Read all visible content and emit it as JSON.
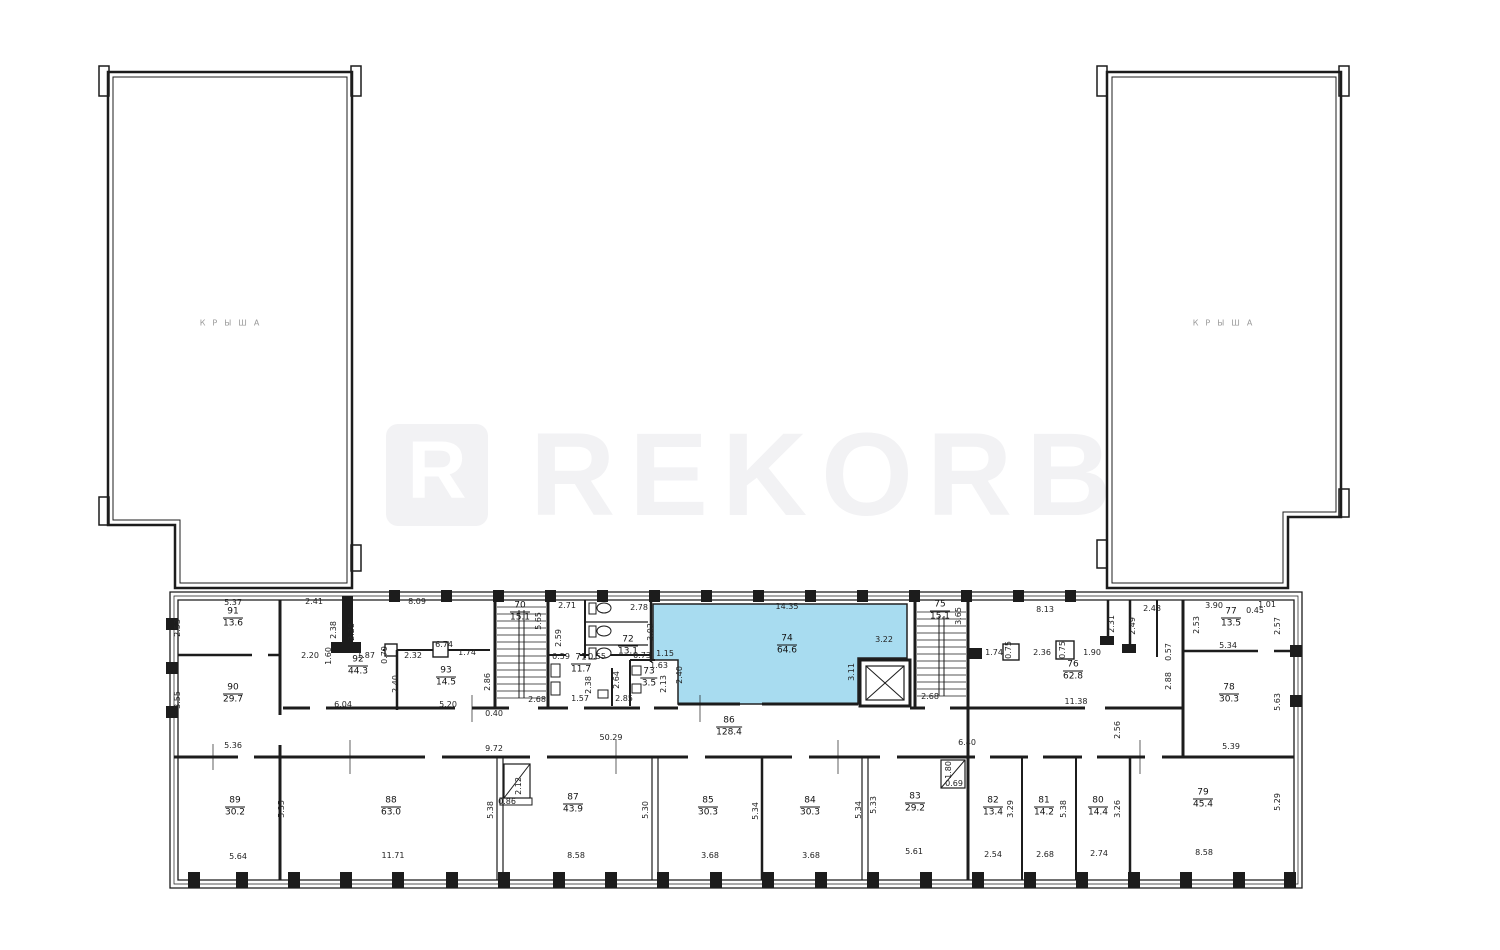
{
  "plan": {
    "towers": {
      "left_label": "КРЫША",
      "right_label": "КРЫША"
    },
    "watermark": {
      "logo_letter": "R",
      "text": "REKORB"
    },
    "highlight": {
      "number": "74",
      "area": "64.6",
      "fill": "#a8dcf0"
    },
    "rooms": [
      {
        "number": "91",
        "area": "13.6",
        "x": 233,
        "y": 618
      },
      {
        "number": "90",
        "area": "29.7",
        "x": 233,
        "y": 694
      },
      {
        "number": "92",
        "area": "44.3",
        "x": 358,
        "y": 666
      },
      {
        "number": "93",
        "area": "14.5",
        "x": 446,
        "y": 677
      },
      {
        "number": "70",
        "area": "15.1",
        "x": 520,
        "y": 612
      },
      {
        "number": "71",
        "area": "11.7",
        "x": 581,
        "y": 664
      },
      {
        "number": "72",
        "area": "13.1",
        "x": 628,
        "y": 646
      },
      {
        "number": "73",
        "area": "3.5",
        "x": 649,
        "y": 678
      },
      {
        "number": "74",
        "area": "64.6",
        "x": 787,
        "y": 645,
        "highlight": true
      },
      {
        "number": "75",
        "area": "15.1",
        "x": 940,
        "y": 611
      },
      {
        "number": "76",
        "area": "62.8",
        "x": 1073,
        "y": 671
      },
      {
        "number": "77",
        "area": "13.5",
        "x": 1231,
        "y": 618
      },
      {
        "number": "78",
        "area": "30.3",
        "x": 1229,
        "y": 694
      },
      {
        "number": "86",
        "area": "128.4",
        "x": 729,
        "y": 727
      },
      {
        "number": "89",
        "area": "30.2",
        "x": 235,
        "y": 807
      },
      {
        "number": "88",
        "area": "63.0",
        "x": 391,
        "y": 807
      },
      {
        "number": "87",
        "area": "43.9",
        "x": 573,
        "y": 804
      },
      {
        "number": "85",
        "area": "30.3",
        "x": 708,
        "y": 807
      },
      {
        "number": "84",
        "area": "30.3",
        "x": 810,
        "y": 807
      },
      {
        "number": "83",
        "area": "29.2",
        "x": 915,
        "y": 803
      },
      {
        "number": "82",
        "area": "13.4",
        "x": 993,
        "y": 807
      },
      {
        "number": "81",
        "area": "14.2",
        "x": 1044,
        "y": 807
      },
      {
        "number": "80",
        "area": "14.4",
        "x": 1098,
        "y": 807
      },
      {
        "number": "79",
        "area": "45.4",
        "x": 1203,
        "y": 799
      }
    ],
    "dimensions": [
      {
        "t": "5.37",
        "x": 233,
        "y": 603
      },
      {
        "t": "2.53",
        "x": 178,
        "y": 628,
        "r": 1
      },
      {
        "t": "3.55",
        "x": 178,
        "y": 700,
        "r": 1
      },
      {
        "t": "5.36",
        "x": 233,
        "y": 746
      },
      {
        "t": "2.41",
        "x": 314,
        "y": 602
      },
      {
        "t": "2.38",
        "x": 334,
        "y": 630,
        "r": 1
      },
      {
        "t": "2.28",
        "x": 352,
        "y": 632,
        "r": 1
      },
      {
        "t": "8.09",
        "x": 417,
        "y": 602
      },
      {
        "t": "2.20",
        "x": 310,
        "y": 656
      },
      {
        "t": "1.60",
        "x": 329,
        "y": 656,
        "r": 1
      },
      {
        "t": "1.87",
        "x": 366,
        "y": 656
      },
      {
        "t": "0.79",
        "x": 385,
        "y": 655,
        "r": 1
      },
      {
        "t": "2.32",
        "x": 413,
        "y": 656
      },
      {
        "t": "6.74",
        "x": 444,
        "y": 645
      },
      {
        "t": "1.74",
        "x": 467,
        "y": 653
      },
      {
        "t": "2.40",
        "x": 396,
        "y": 684,
        "r": 1
      },
      {
        "t": "2.86",
        "x": 488,
        "y": 682,
        "r": 1
      },
      {
        "t": "6.04",
        "x": 343,
        "y": 705
      },
      {
        "t": "5.20",
        "x": 448,
        "y": 705
      },
      {
        "t": "0.40",
        "x": 494,
        "y": 714
      },
      {
        "t": "2.68",
        "x": 537,
        "y": 700
      },
      {
        "t": "5.65",
        "x": 539,
        "y": 621,
        "r": 1
      },
      {
        "t": "2.71",
        "x": 567,
        "y": 606
      },
      {
        "t": "2.59",
        "x": 559,
        "y": 638,
        "r": 1
      },
      {
        "t": "2.78",
        "x": 639,
        "y": 608
      },
      {
        "t": "3.02",
        "x": 651,
        "y": 632,
        "r": 1
      },
      {
        "t": "0.59",
        "x": 561,
        "y": 657
      },
      {
        "t": "0.55",
        "x": 597,
        "y": 657
      },
      {
        "t": "0.73",
        "x": 642,
        "y": 656
      },
      {
        "t": "1.15",
        "x": 665,
        "y": 654
      },
      {
        "t": "1.63",
        "x": 659,
        "y": 666
      },
      {
        "t": "2.13",
        "x": 664,
        "y": 684,
        "r": 1
      },
      {
        "t": "2.38",
        "x": 589,
        "y": 685,
        "r": 1
      },
      {
        "t": "2.64",
        "x": 617,
        "y": 680,
        "r": 1
      },
      {
        "t": "1.57",
        "x": 580,
        "y": 699
      },
      {
        "t": "2.85",
        "x": 624,
        "y": 699
      },
      {
        "t": "2.40",
        "x": 680,
        "y": 675,
        "r": 1
      },
      {
        "t": "14.35",
        "x": 787,
        "y": 607
      },
      {
        "t": "3.22",
        "x": 884,
        "y": 640
      },
      {
        "t": "3.11",
        "x": 852,
        "y": 672,
        "r": 1
      },
      {
        "t": "3.65",
        "x": 959,
        "y": 616,
        "r": 1
      },
      {
        "t": "2.68",
        "x": 930,
        "y": 697
      },
      {
        "t": "8.13",
        "x": 1045,
        "y": 610
      },
      {
        "t": "1.74",
        "x": 994,
        "y": 653
      },
      {
        "t": "0.75",
        "x": 1009,
        "y": 650,
        "r": 1
      },
      {
        "t": "2.36",
        "x": 1042,
        "y": 653
      },
      {
        "t": "0.75",
        "x": 1063,
        "y": 650,
        "r": 1
      },
      {
        "t": "1.90",
        "x": 1092,
        "y": 653
      },
      {
        "t": "2.31",
        "x": 1112,
        "y": 624,
        "r": 1
      },
      {
        "t": "2.49",
        "x": 1133,
        "y": 626,
        "r": 1
      },
      {
        "t": "2.48",
        "x": 1152,
        "y": 609
      },
      {
        "t": "11.38",
        "x": 1076,
        "y": 702
      },
      {
        "t": "2.56",
        "x": 1118,
        "y": 730,
        "r": 1
      },
      {
        "t": "6.40",
        "x": 967,
        "y": 743
      },
      {
        "t": "1.80",
        "x": 949,
        "y": 770,
        "r": 1
      },
      {
        "t": "0.69",
        "x": 954,
        "y": 784
      },
      {
        "t": "3.90",
        "x": 1214,
        "y": 606
      },
      {
        "t": "0.45",
        "x": 1255,
        "y": 611
      },
      {
        "t": "1.01",
        "x": 1267,
        "y": 605
      },
      {
        "t": "2.53",
        "x": 1197,
        "y": 625,
        "r": 1
      },
      {
        "t": "2.57",
        "x": 1278,
        "y": 626,
        "r": 1
      },
      {
        "t": "5.34",
        "x": 1228,
        "y": 646
      },
      {
        "t": "0.57",
        "x": 1169,
        "y": 652,
        "r": 1
      },
      {
        "t": "2.88",
        "x": 1169,
        "y": 681,
        "r": 1
      },
      {
        "t": "5.63",
        "x": 1278,
        "y": 702,
        "r": 1
      },
      {
        "t": "5.39",
        "x": 1231,
        "y": 747
      },
      {
        "t": "5.29",
        "x": 1278,
        "y": 802,
        "r": 1
      },
      {
        "t": "50.29",
        "x": 611,
        "y": 738
      },
      {
        "t": "9.72",
        "x": 494,
        "y": 749
      },
      {
        "t": "2.12",
        "x": 519,
        "y": 786,
        "r": 1
      },
      {
        "t": "0.86",
        "x": 507,
        "y": 802
      },
      {
        "t": "5.64",
        "x": 238,
        "y": 857
      },
      {
        "t": "5.35",
        "x": 282,
        "y": 809,
        "r": 1
      },
      {
        "t": "11.71",
        "x": 393,
        "y": 856
      },
      {
        "t": "5.38",
        "x": 491,
        "y": 810,
        "r": 1
      },
      {
        "t": "8.58",
        "x": 576,
        "y": 856
      },
      {
        "t": "5.30",
        "x": 646,
        "y": 810,
        "r": 1
      },
      {
        "t": "3.68",
        "x": 710,
        "y": 856
      },
      {
        "t": "5.34",
        "x": 756,
        "y": 811,
        "r": 1
      },
      {
        "t": "3.68",
        "x": 811,
        "y": 856
      },
      {
        "t": "5.34",
        "x": 859,
        "y": 810,
        "r": 1
      },
      {
        "t": "5.33",
        "x": 874,
        "y": 805,
        "r": 1
      },
      {
        "t": "5.61",
        "x": 914,
        "y": 852
      },
      {
        "t": "2.54",
        "x": 993,
        "y": 855
      },
      {
        "t": "3.29",
        "x": 1011,
        "y": 809,
        "r": 1
      },
      {
        "t": "2.68",
        "x": 1045,
        "y": 855
      },
      {
        "t": "5.38",
        "x": 1064,
        "y": 809,
        "r": 1
      },
      {
        "t": "2.74",
        "x": 1099,
        "y": 854
      },
      {
        "t": "3.26",
        "x": 1118,
        "y": 809,
        "r": 1
      },
      {
        "t": "8.58",
        "x": 1204,
        "y": 853
      }
    ]
  }
}
